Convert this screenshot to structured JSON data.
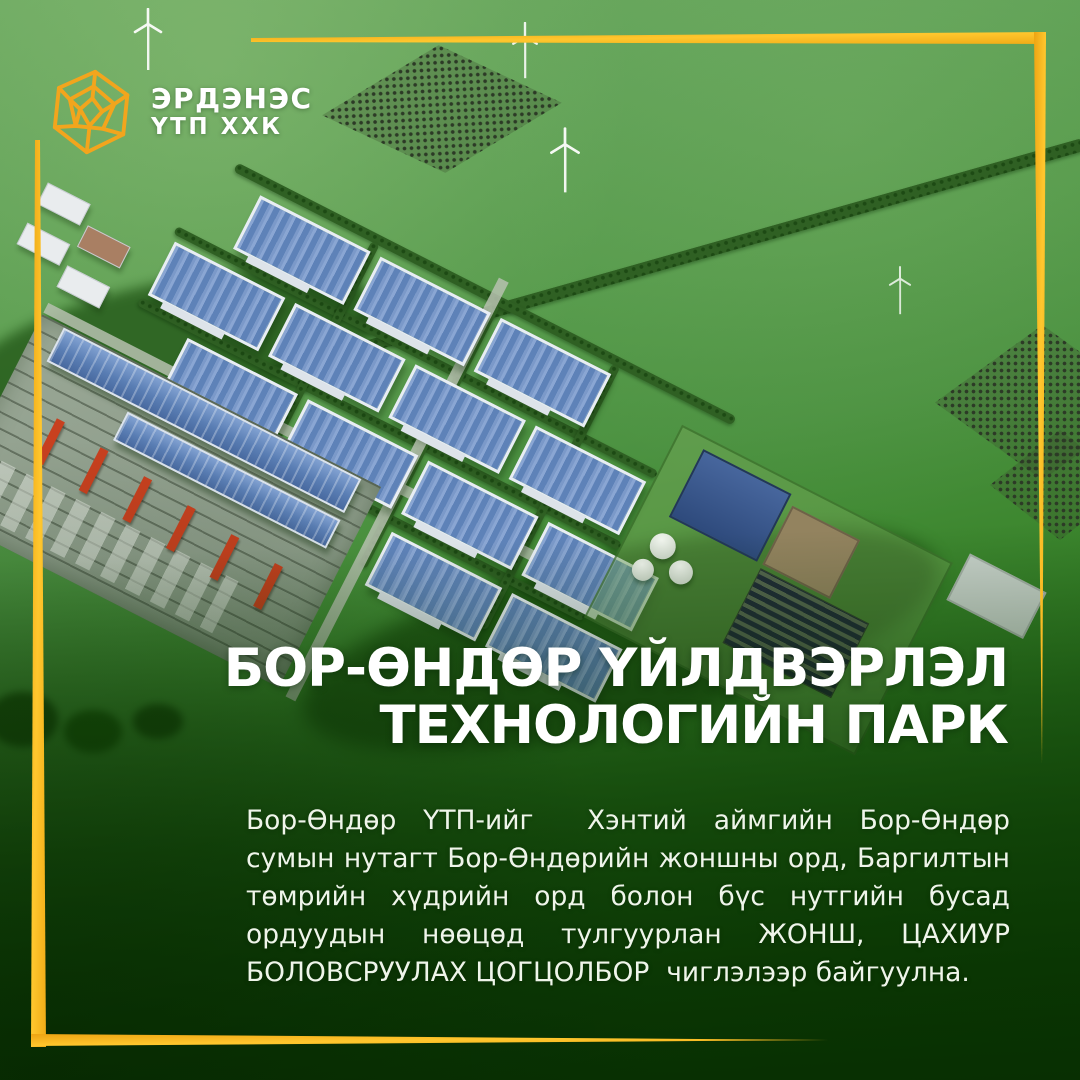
{
  "brand": {
    "logo_icon": "gem-hexagon-icon",
    "company_line1": "ЭРДЭНЭС",
    "company_line2": "ҮТП ХХК"
  },
  "title": {
    "lines": [
      "БОР-ӨНДӨР ҮЙЛДВЭРЛЭЛ",
      "ТЕХНОЛОГИЙН ПАРК"
    ]
  },
  "body": {
    "lines": [
      "Бор-Өндөр ҮТП-ийг  Хэнтий аймгийн Бор-Өндөр",
      "сумын нутагт Бор-Өндөрийн жоншны орд, Баргилтын",
      "төмрийн хүдрийн орд болон бүс нутгийн бусад",
      "ордуудын нөөцөд тулгуурлан ЖОНШ, ЦАХИУР",
      "БОЛОВСРУУЛАХ ЦОГЦОЛБОР  чиглэлээр байгуулна."
    ]
  },
  "icons": {
    "wind_turbine": "wind-turbine-icon"
  },
  "colors": {
    "accent_gold": "#F6B41F",
    "logo_gold": "#F2A51D",
    "text_white": "#FFFFFF",
    "body_text": "#EFF5EA",
    "grass_top": "#61A257",
    "grass_bottom": "#104E04",
    "factory_roof_blue": "#5E82B8",
    "crane_red": "#C8401F"
  }
}
